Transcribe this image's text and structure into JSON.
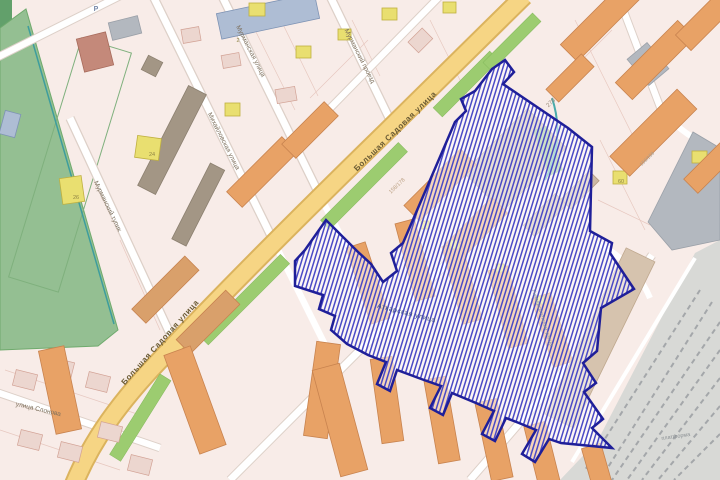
{
  "map": {
    "description_label": "city map with selected redevelopment area polygon",
    "colors": {
      "block_pink": "#f8ece8",
      "road_fill": "#f6d584",
      "road_casing": "#dbb35e",
      "park_green": "#94bf92",
      "boulevard_green": "#9ccc70",
      "water_teal": "#3d9d9d",
      "railway_gray": "#d8d9d6",
      "building_orange": "#e8a266",
      "building_yellow": "#e9df70",
      "selection_border": "#1f1f99",
      "selection_hatch": "#4a4ac6"
    },
    "labels": [
      {
        "name": "label-bolshaya-sadovaya-upper",
        "text": "Большая Садовая улица",
        "x": 397,
        "y": 133,
        "rot": -44,
        "size": 8,
        "color": "#6a5a33",
        "ls": 0.6,
        "bold": true
      },
      {
        "name": "label-bolshaya-sadovaya-lower",
        "text": "Большая Садовая улица",
        "x": 162,
        "y": 344,
        "rot": -48,
        "size": 8,
        "color": "#6a5a33",
        "ls": 0.6,
        "bold": true
      },
      {
        "name": "label-murmanskaya-ulitsa",
        "text": "Мурманская улица",
        "x": 249,
        "y": 52,
        "rot": 63,
        "size": 6.5,
        "color": "#7d6f5c",
        "ls": 0
      },
      {
        "name": "label-murmansky-proezd",
        "text": "Мурманский проезд",
        "x": 358,
        "y": 57,
        "rot": 63,
        "size": 6.5,
        "color": "#7d6f5c",
        "ls": 0
      },
      {
        "name": "label-mikhailovskaya-ulitsa",
        "text": "Михайловская улица",
        "x": 222,
        "y": 142,
        "rot": 63,
        "size": 6.5,
        "color": "#7d6f5c",
        "ls": 0
      },
      {
        "name": "label-murmansky-tupik",
        "text": "Мурманский тупик",
        "x": 106,
        "y": 207,
        "rot": 64,
        "size": 6.5,
        "color": "#7d6f5c",
        "ls": 0
      },
      {
        "name": "label-ulitsa-slonova",
        "text": "улица Слонова",
        "x": 38,
        "y": 411,
        "rot": 13,
        "size": 6.5,
        "color": "#7d6f5c",
        "ls": 0
      },
      {
        "name": "label-atkarskaya-ulitsa",
        "text": "Аткарская улица",
        "x": 406,
        "y": 315,
        "rot": 14,
        "size": 7,
        "color": "#3c4d85",
        "ls": 0.4
      },
      {
        "name": "label-universitetskaya-ulitsa",
        "text": "Университетская улица",
        "x": 541,
        "y": 318,
        "rot": 72,
        "size": 5.5,
        "color": "#8d96a0",
        "ls": 0
      },
      {
        "name": "label-platforma",
        "text": "платформа",
        "x": 676,
        "y": 438,
        "rot": -8,
        "size": 5.5,
        "color": "#8b9094",
        "ls": 0
      },
      {
        "name": "building-number-278",
        "text": "278",
        "x": 552,
        "y": 104,
        "rot": -44,
        "size": 6,
        "color": "#9b8d7c",
        "ls": 0
      },
      {
        "name": "building-number-158-178",
        "text": "158/178",
        "x": 398,
        "y": 187,
        "rot": -44,
        "size": 5.5,
        "color": "#bda285",
        "ls": 0
      },
      {
        "name": "building-number-156-158",
        "text": "156/158",
        "x": 648,
        "y": 160,
        "rot": -44,
        "size": 5,
        "color": "#a99d8e",
        "ls": 0
      },
      {
        "name": "building-number-60",
        "text": "60",
        "x": 621,
        "y": 183,
        "rot": 0,
        "size": 5.5,
        "color": "#8f8445",
        "ls": 0
      },
      {
        "name": "building-number-24",
        "text": "24",
        "x": 152,
        "y": 156,
        "rot": 0,
        "size": 5.5,
        "color": "#8f8445",
        "ls": 0
      },
      {
        "name": "building-number-26",
        "text": "26",
        "x": 76,
        "y": 199,
        "rot": 0,
        "size": 5.5,
        "color": "#8f8445",
        "ls": 0
      },
      {
        "name": "building-number-2",
        "text": "2",
        "x": 238,
        "y": 42,
        "rot": 0,
        "size": 5.5,
        "color": "#8f8445",
        "ls": 0
      },
      {
        "name": "parking-label",
        "text": "Р",
        "x": 96,
        "y": 11,
        "rot": 0,
        "size": 7,
        "color": "#7788a8",
        "ls": 0,
        "bold": true
      }
    ]
  }
}
